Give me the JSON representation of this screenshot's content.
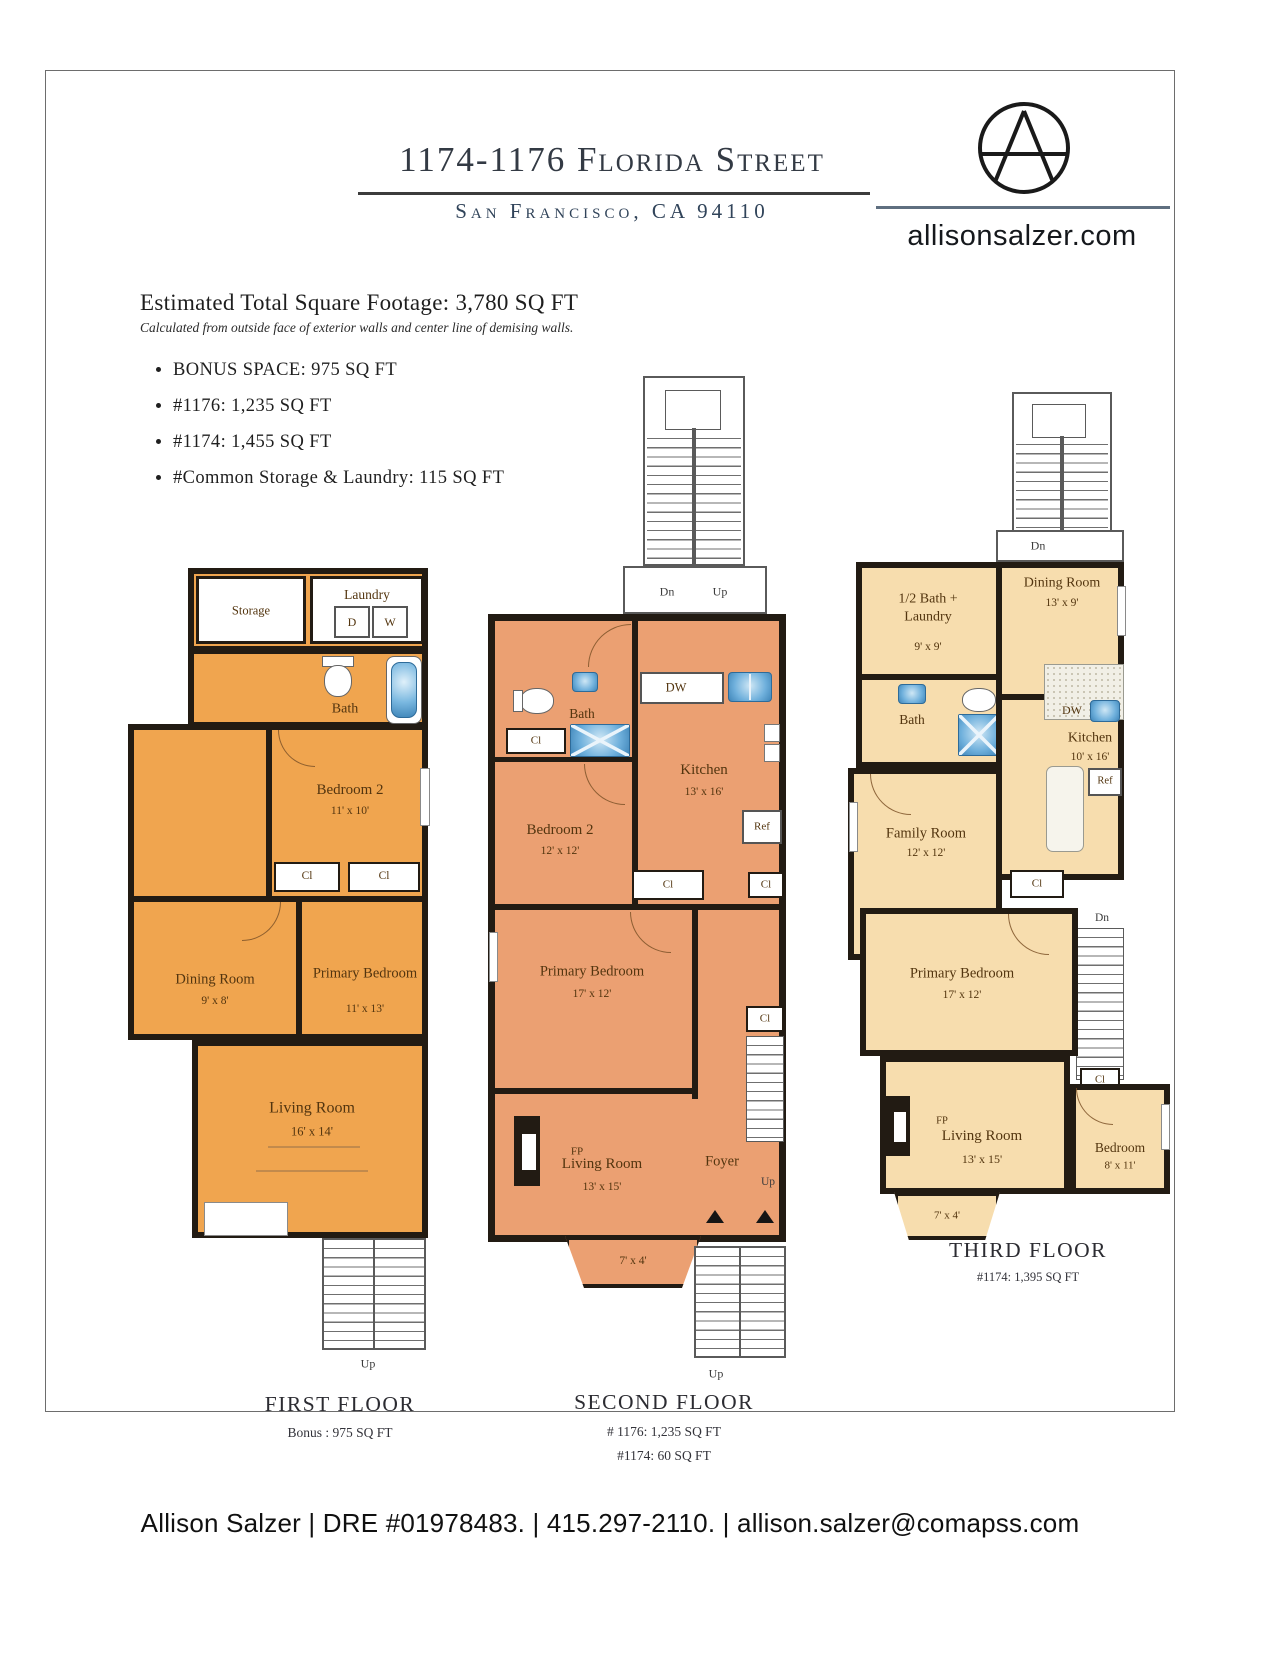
{
  "header": {
    "title": "1174-1176 Florida Street",
    "subtitle": "San Francisco, CA 94110"
  },
  "brand": {
    "website": "allisonsalzer.com"
  },
  "summary": {
    "heading": "Estimated Total Square Footage: 3,780 SQ FT",
    "note": "Calculated from outside face of exterior walls and center line of demising walls.",
    "bullets": [
      "BONUS SPACE: 975 SQ FT",
      "#1176: 1,235 SQ FT",
      "#1174: 1,455 SQ FT",
      "#Common Storage & Laundry: 115 SQ FT"
    ]
  },
  "floor1": {
    "title": "FIRST FLOOR",
    "note": "Bonus : 975 SQ FT",
    "storage": "Storage",
    "laundry": "Laundry",
    "dryer": "D",
    "washer": "W",
    "bath": "Bath",
    "bedroom2": "Bedroom 2",
    "bedroom2_dims": "11' x 10'",
    "cl": "Cl",
    "dining": "Dining Room",
    "dining_dims": "9' x 8'",
    "primary": "Primary Bedroom",
    "primary_dims": "11' x 13'",
    "living": "Living Room",
    "living_dims": "16' x 14'",
    "up": "Up"
  },
  "floor2": {
    "title": "SECOND FLOOR",
    "note1": "# 1176: 1,235 SQ FT",
    "note2": "#1174: 60 SQ FT",
    "dn": "Dn",
    "up": "Up",
    "bath": "Bath",
    "cl": "Cl",
    "bedroom2": "Bedroom 2",
    "bedroom2_dims": "12' x 12'",
    "kitchen": "Kitchen",
    "kitchen_dims": "13' x 16'",
    "dw": "DW",
    "ref": "Ref",
    "primary": "Primary Bedroom",
    "primary_dims": "17' x 12'",
    "fp": "FP",
    "living": "Living Room",
    "living_dims": "13' x 15'",
    "foyer": "Foyer",
    "foyer_up": "Up",
    "bay_dims": "7' x 4'",
    "stairs_up": "Up"
  },
  "floor3": {
    "title": "THIRD FLOOR",
    "note": "#1174: 1,395 SQ FT",
    "dn": "Dn",
    "half_bath_line1": "1/2 Bath +",
    "half_bath_line2": "Laundry",
    "half_bath_dims": "9' x 9'",
    "dining": "Dining Room",
    "dining_dims": "13' x 9'",
    "bath": "Bath",
    "kitchen": "Kitchen",
    "kitchen_dims": "10' x 16'",
    "dw": "DW",
    "ref": "Ref",
    "family": "Family Room",
    "family_dims": "12' x 12'",
    "primary": "Primary Bedroom",
    "primary_dims": "17' x 12'",
    "cl": "Cl",
    "fp": "FP",
    "living": "Living Room",
    "living_dims": "13' x 15'",
    "bedroom": "Bedroom",
    "bedroom_dims": "8' x 11'",
    "bay_dims": "7' x 4'",
    "dn2": "Dn"
  },
  "footer": {
    "contact": "Allison Salzer | DRE #01978483. | 415.297-2110. | allison.salzer@comapss.com"
  },
  "colors": {
    "floor1_fill": "#f0a54f",
    "floor2_fill": "#eba072",
    "floor3_fill": "#f7ddae",
    "wall": "#221b13",
    "fixture_blue": "#6fb0dc",
    "title_text": "#333a44",
    "subtitle_text": "#31445a"
  }
}
